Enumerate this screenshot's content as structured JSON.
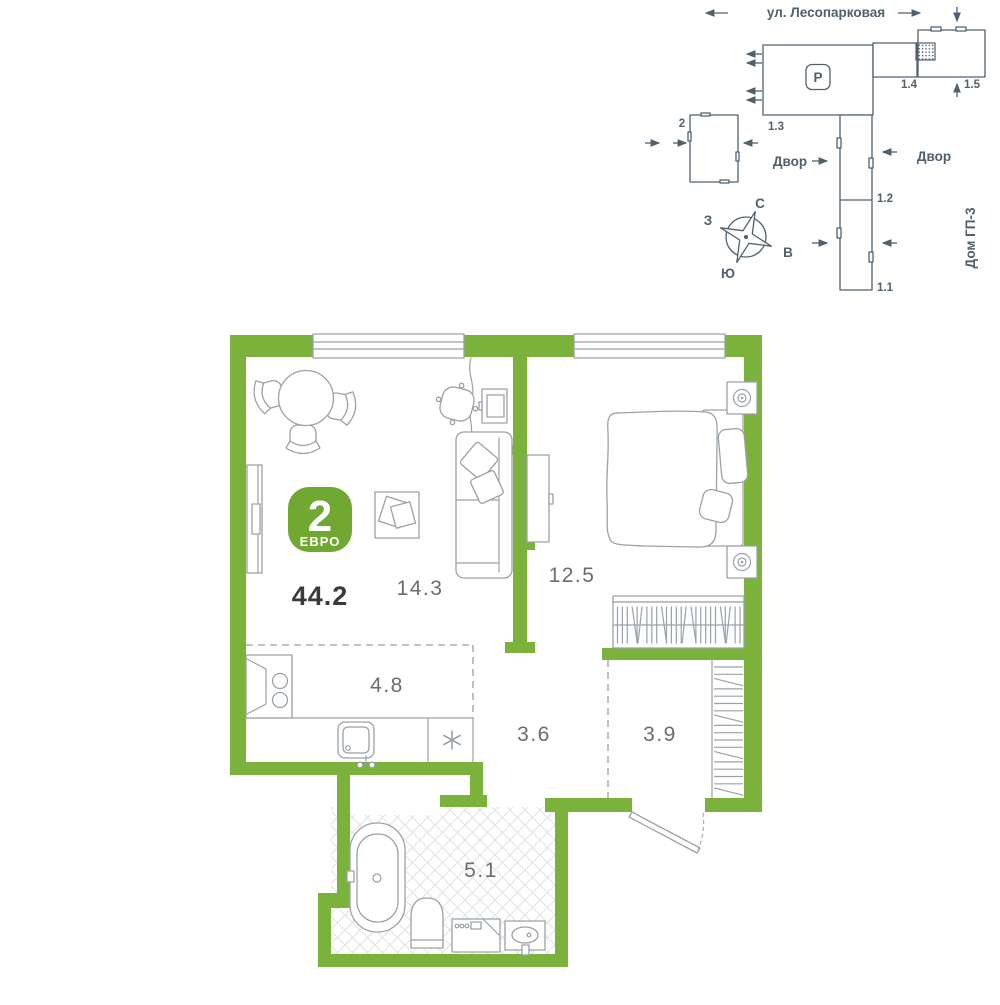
{
  "colors": {
    "wall_green": "#7ab23c",
    "badge_green": "#70a832",
    "line_slate": "#50616d",
    "furniture_gray": "#9aa2a8",
    "label_gray": "#6d6d6d",
    "dark_text": "#3a3a3a",
    "dash_gray": "#aab1b6",
    "tile_gray": "#e0e3e5"
  },
  "floor_plan": {
    "badge": {
      "rooms": "2",
      "type": "ЕВРО"
    },
    "total_area": "44.2",
    "areas": {
      "living": "14.3",
      "bedroom": "12.5",
      "kitchen": "4.8",
      "hallway": "3.6",
      "corridor": "3.9",
      "bathroom": "5.1"
    }
  },
  "site_plan": {
    "street": "ул. Лесопарковая",
    "parking": "P",
    "labels": {
      "b13": "1.3",
      "b14": "1.4",
      "b15": "1.5",
      "b12": "1.2",
      "b11": "1.1",
      "b2": "2"
    },
    "courtyard_left": "Двор",
    "courtyard_right": "Двор",
    "house": "Дом ГП-3",
    "compass": {
      "n": "С",
      "s": "Ю",
      "w": "З",
      "e": "В"
    }
  }
}
